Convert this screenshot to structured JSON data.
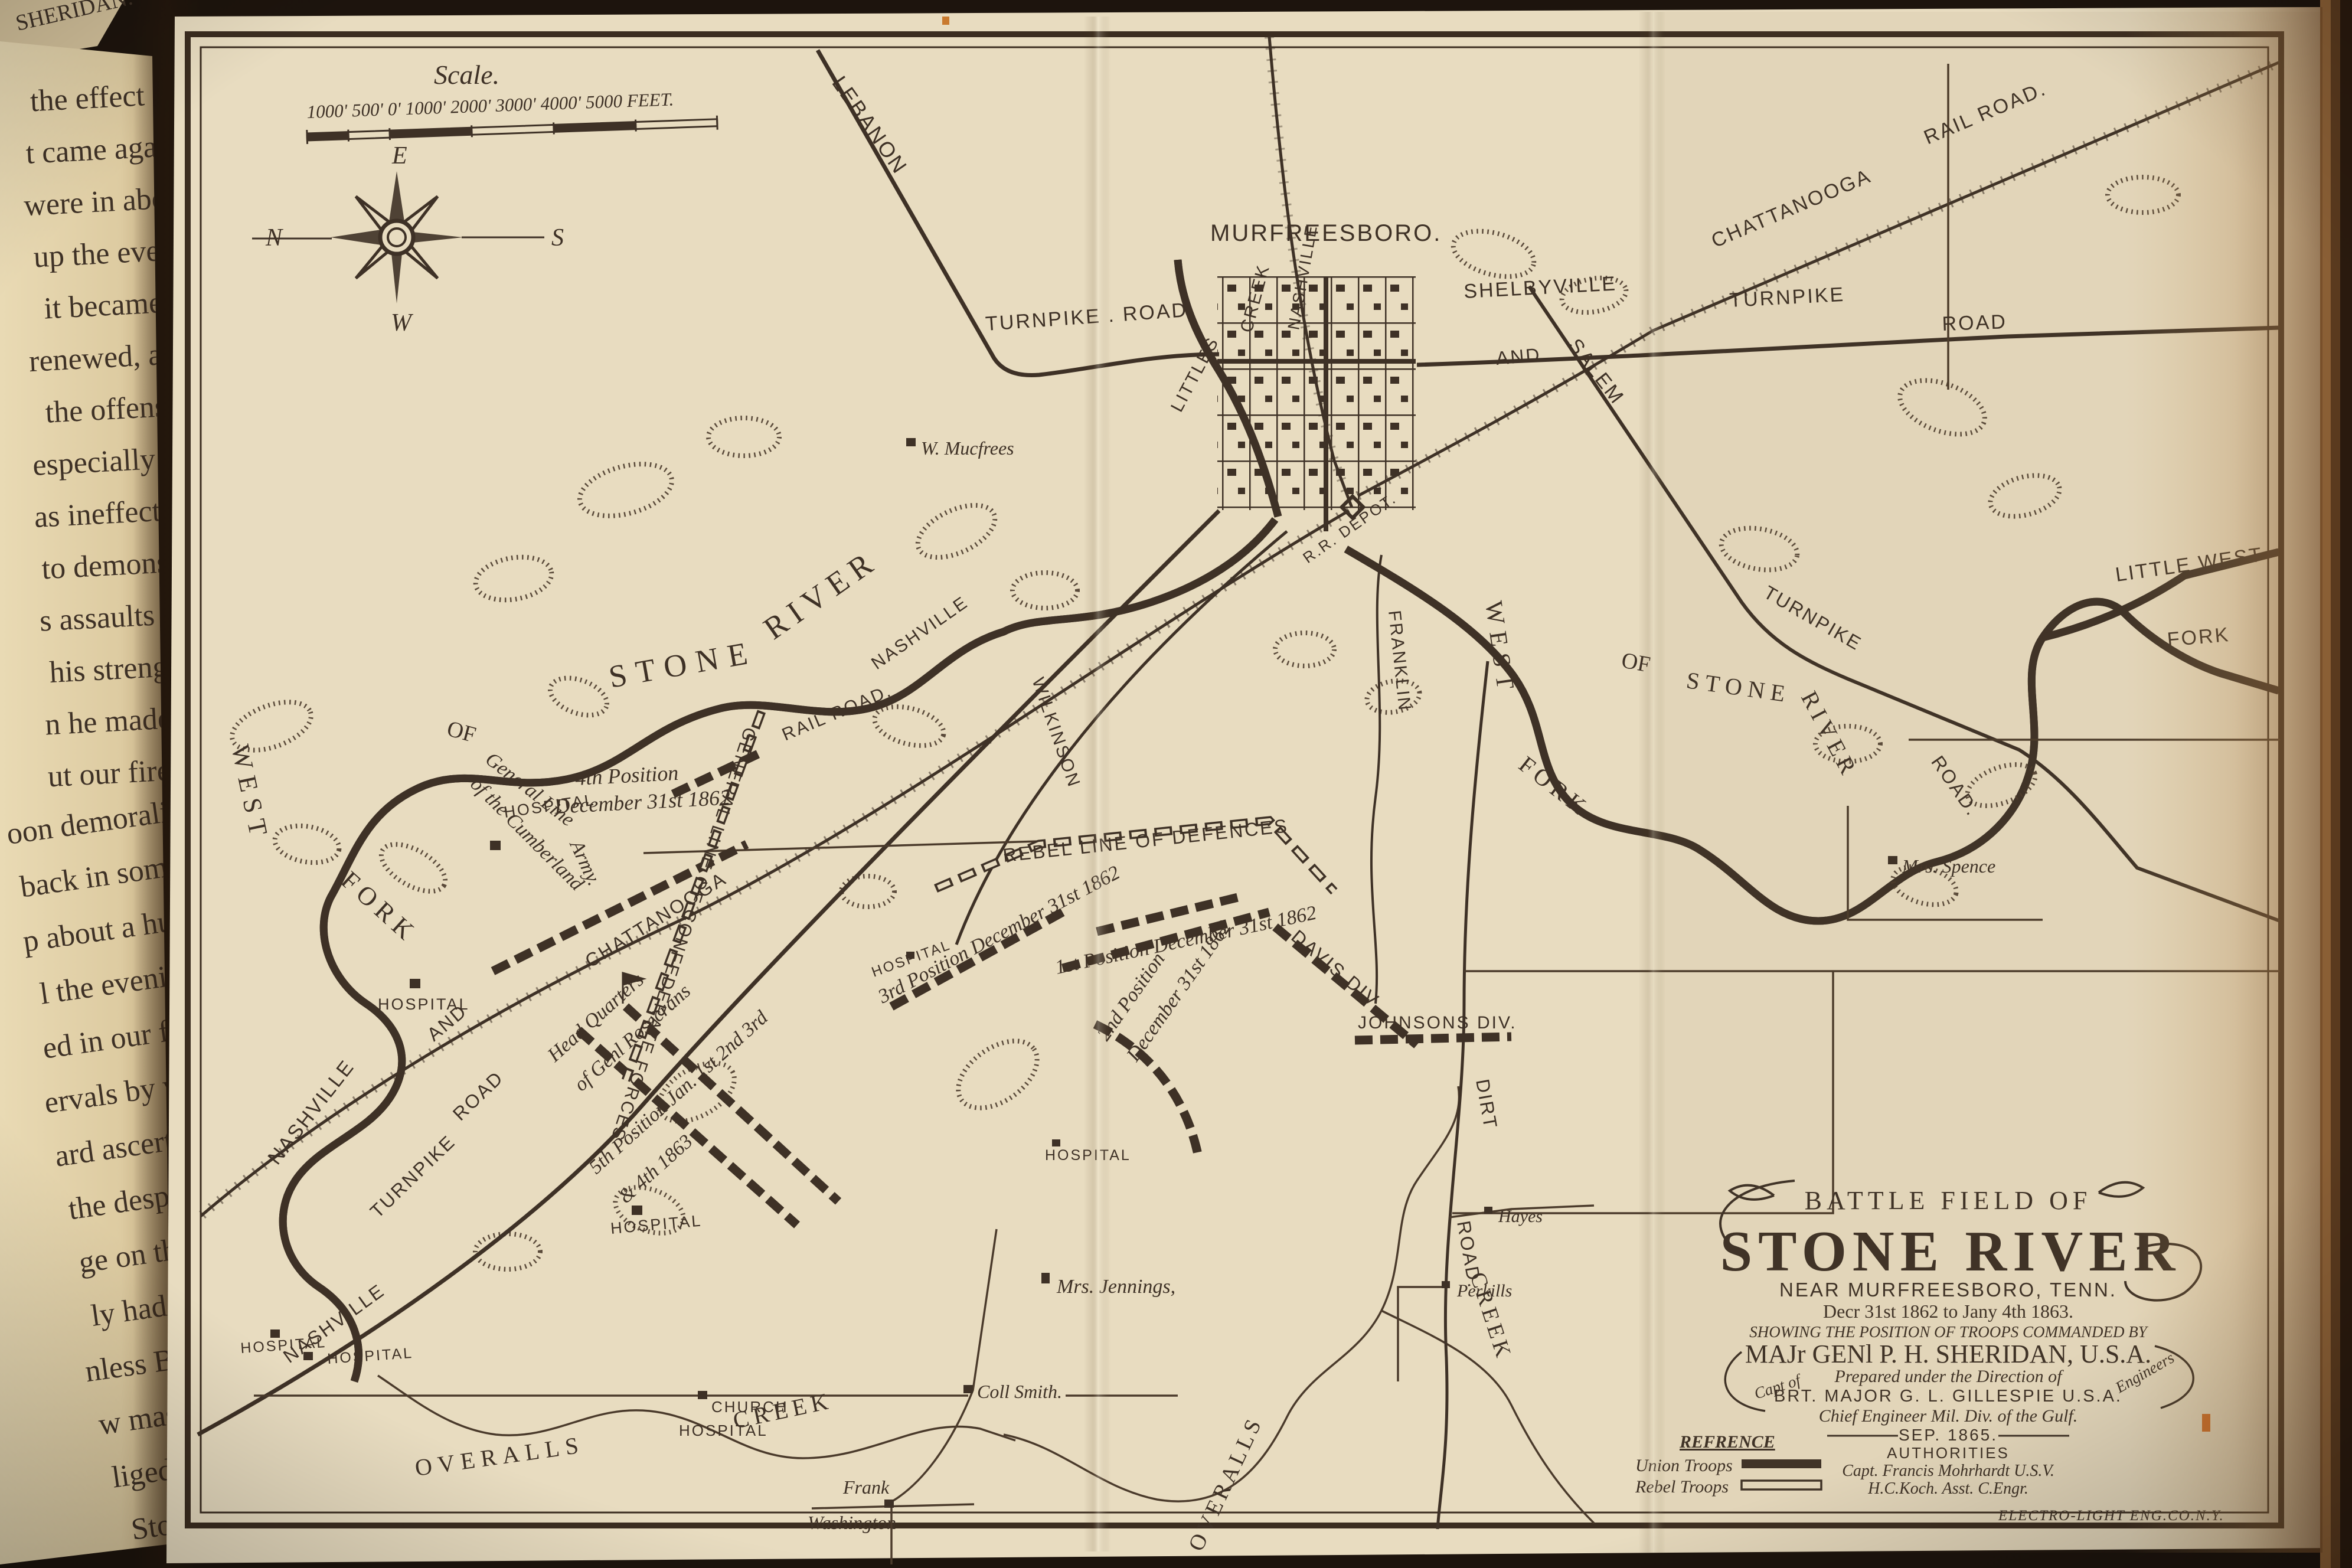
{
  "colors": {
    "ink": "#3e3126",
    "paper": "#e8dcc0",
    "dark_background": "#1d140d"
  },
  "book": {
    "page_header": "SHERIDAN.",
    "left_page_lines": [
      "the effect of the",
      "t came again the",
      "were in about the",
      "up the evening be",
      "it became eviden",
      "renewed, and a litt",
      "the offensive by a",
      "especially on Walk",
      "as ineffectual, howe",
      "to demonstrate that t",
      "s assaults the day bef",
      "his strength.  Abou",
      "n he made another fei",
      "ut our fire from the li",
      "oon demoralized his ad",
      "back in some confusion",
      "p about a hundred prison",
      "l the evening of Janua",
      "ed in our front, and con",
      "ervals by weak demonstr",
      "ard ascertained were de",
      "the desperate assault he",
      "ge on the left of Rosecr",
      "ly had in view only a del",
      "nless Bragg dislodged th",
      "w massing in front of his",
      "liged to withdraw Genera",
      "Stone River and finally"
    ]
  },
  "map": {
    "scale": {
      "title": "Scale.",
      "ticks": "1000'  500'  0'         1000'         2000'        3000'       4000'      5000 FEET."
    },
    "compass": {
      "n": "N",
      "e": "E",
      "s": "S",
      "w": "W"
    },
    "towns": {
      "murfreesboro": "MURFREESBORO."
    },
    "roads": {
      "lebanon": "LEBANON",
      "lebanon_tpk": "TURNPIKE . ROAD",
      "shelbyville": "SHELBYVILLE",
      "and_top": "AND",
      "shelby_tpk": "TURNPIKE",
      "shelby_road": "ROAD",
      "chattanooga_rr": "CHATTANOOGA",
      "rail_road_top": "RAIL ROAD.",
      "rr_nashville_depot": "NASHVILLE",
      "rr_depot": "R.R. DEPOT.",
      "rr_nashville_1": "NASHVILLE",
      "rr_railroad": "RAIL ROAD.",
      "rr_chattanooga": "CHATTANOOGA",
      "rr_and": "AND",
      "rr_nashville_2": "NASHVILLE",
      "tpk_road": "ROAD",
      "tpk_turnpike": "TURNPIKE",
      "tpk_nashville": "NASHVILLE",
      "wilkinson": "WILKINSON",
      "franklin": "FRANKLIN",
      "dirt": "DIRT",
      "dirt_road": "ROAD.",
      "salem": "SALEM",
      "salem_tpk": "TURNPIKE",
      "salem_road": "ROAD."
    },
    "waters": {
      "stone_big": "STONE",
      "river_big": "RIVER",
      "west_l": "WEST",
      "fork_l": "FORK",
      "of_l": "OF",
      "littles": "LITTLES",
      "creek_u": "CREEK",
      "west_r": "WEST",
      "fork_r": "FORK",
      "of_r": "OF",
      "stone_r": "STONE",
      "river_r": "RIVER",
      "little_west": "LITTLE WEST",
      "fork_lw": "FORK",
      "overalls_b": "OVERALLS",
      "creek_b": "CREEK",
      "overalls_r": "OVERALLS",
      "creek_r": "CREEK"
    },
    "positions": {
      "pos4_1": "4th Position",
      "pos4_2": "December 31st 1862",
      "pos3": "3rd Position December 31st 1862",
      "pos1": "1st Position December 31st 1862",
      "pos2_1": "2nd Position",
      "pos2_2": "December 31st 1862",
      "pos5_1": "5th Position Jan. 1st 2nd 3rd",
      "pos5_2": "& 4th 1863",
      "davis": "DAVIS DIV.",
      "johnsons": "JOHNSONS DIV.",
      "rebel_line": "REBEL LINE OF DEFENCES",
      "genl_line": "GENERAL LINE OF CONFEDERATE FORCES",
      "cumberland_1": "General Line",
      "cumberland_2": "of the Cumberland",
      "cumberland_3": "Army.",
      "hq_1": "Head Quarters",
      "hq_2": "of Genl Rosecrans"
    },
    "landmarks": {
      "hospital": "HOSPITAL",
      "church": "CHURCH",
      "w_mucfrees": "W. Mucfrees",
      "mrs_spence": "Mrs. Spence",
      "mrs_jennings": "Mrs. Jennings,",
      "coll_smith": "Coll Smith.",
      "frank": "Frank",
      "washington": "Washington",
      "hayes": "Hayes",
      "perkills": "Perkills"
    },
    "title_block": {
      "line1": "BATTLE FIELD OF",
      "line2": "STONE RIVER",
      "line3": "NEAR MURFREESBORO, TENN.",
      "line4": "Decr 31st 1862 to Jany 4th 1863.",
      "line5": "SHOWING THE POSITION OF TROOPS COMMANDED BY",
      "line6": "MAJr GENl P. H. SHERIDAN, U.S.A.",
      "line7": "Prepared under the Direction of",
      "line8": "BRT. MAJOR  G. L. GILLESPIE  U.S.A.",
      "line8a": "Capt of",
      "line8b": "Engineers",
      "line9": "Chief Engineer Mil. Div. of the Gulf.",
      "line10": "SEP. 1865.",
      "line11": "AUTHORITIES",
      "line12": "Capt. Francis Mohrhardt U.S.V.",
      "line13": "H.C.Koch. Asst. C.Engr."
    },
    "reference": {
      "title": "REFRENCE",
      "union": "Union Troops",
      "rebel": "Rebel Troops"
    },
    "credit": "ELECTRO-LIGHT ENG.CO.N.Y."
  }
}
